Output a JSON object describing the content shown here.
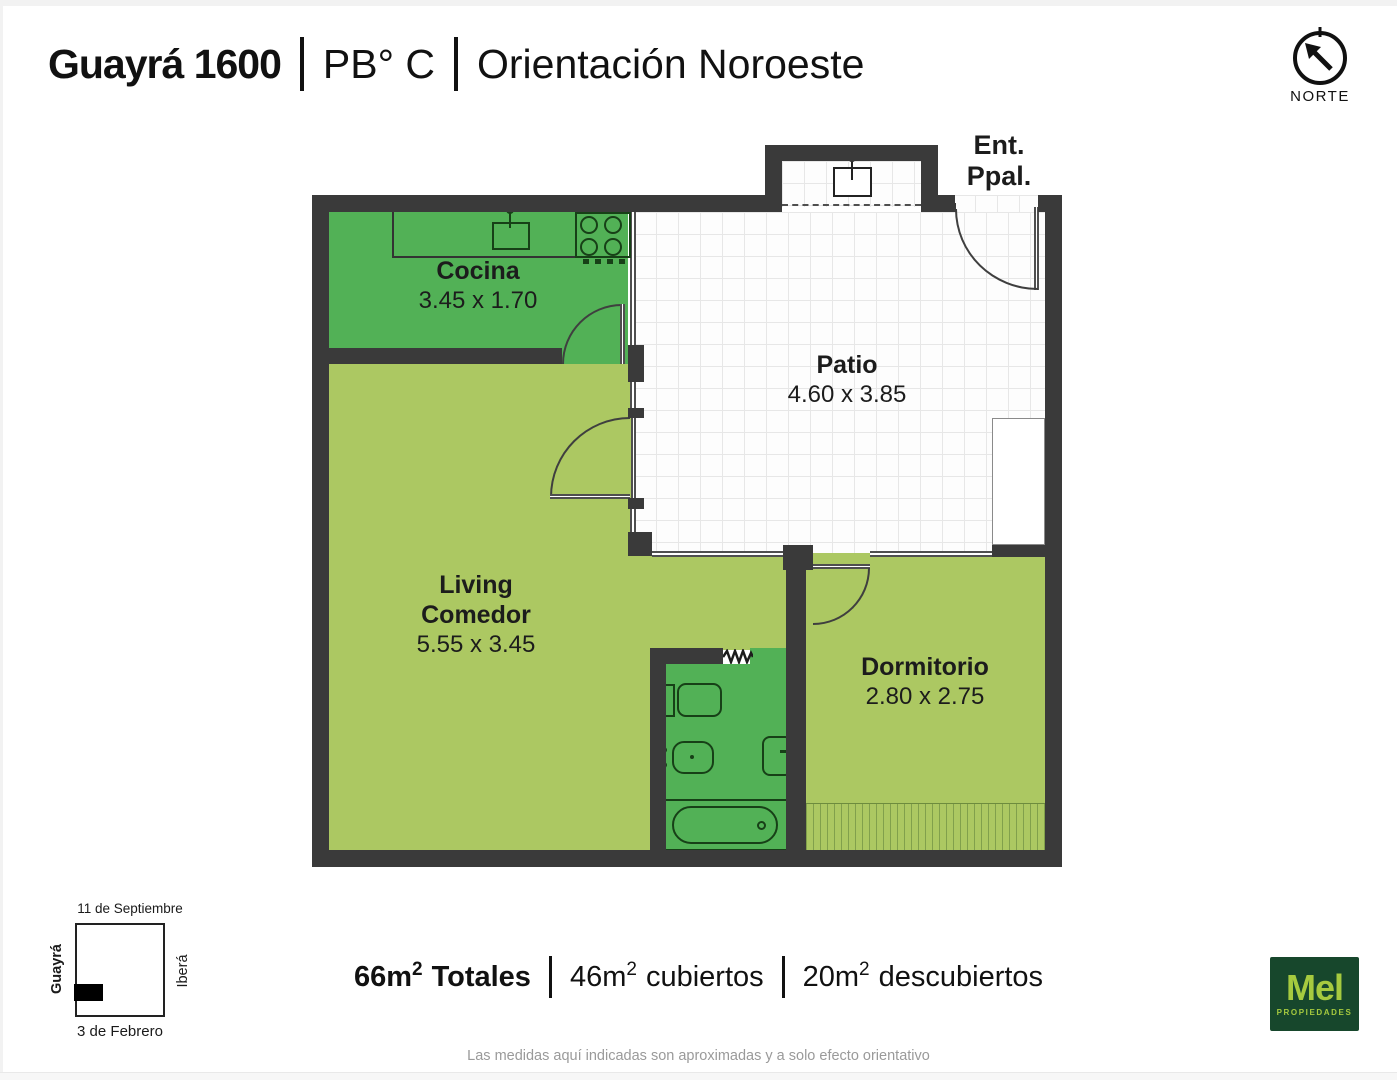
{
  "header": {
    "address": "Guayrá 1600",
    "floor": "PB° C",
    "orientation": "Orientación Noroeste"
  },
  "compass": {
    "label": "NORTE"
  },
  "plan": {
    "entrance": {
      "line1": "Ent.",
      "line2": "Ppal."
    },
    "rooms": {
      "cocina": {
        "name": "Cocina",
        "dims": "3.45 x 1.70"
      },
      "patio": {
        "name": "Patio",
        "dims": "4.60 x 3.85"
      },
      "living": {
        "name1": "Living",
        "name2": "Comedor",
        "dims": "5.55 x 3.45"
      },
      "dormitorio": {
        "name": "Dormitorio",
        "dims": "2.80 x 2.75"
      }
    }
  },
  "location_map": {
    "street_top": "11 de Septiembre",
    "street_left": "Guayrá",
    "street_right": "Iberá",
    "street_bottom": "3 de Febrero"
  },
  "areas": {
    "total": {
      "num": "66m",
      "sup": "2",
      "label": "Totales"
    },
    "covered": {
      "num": "46m",
      "sup": "2",
      "label": "cubiertos"
    },
    "uncovered": {
      "num": "20m",
      "sup": "2",
      "label": "descubiertos"
    }
  },
  "logo": {
    "name": "Mel",
    "subtitle": "PROPIEDADES"
  },
  "disclaimer": "Las medidas aquí indicadas son aproximadas y a solo efecto orientativo",
  "colors": {
    "wall": "#3a3a3a",
    "room_green": "#52b156",
    "room_light_green": "#acc862",
    "logo_bg": "#17472c",
    "logo_text": "#a6ca3f"
  }
}
